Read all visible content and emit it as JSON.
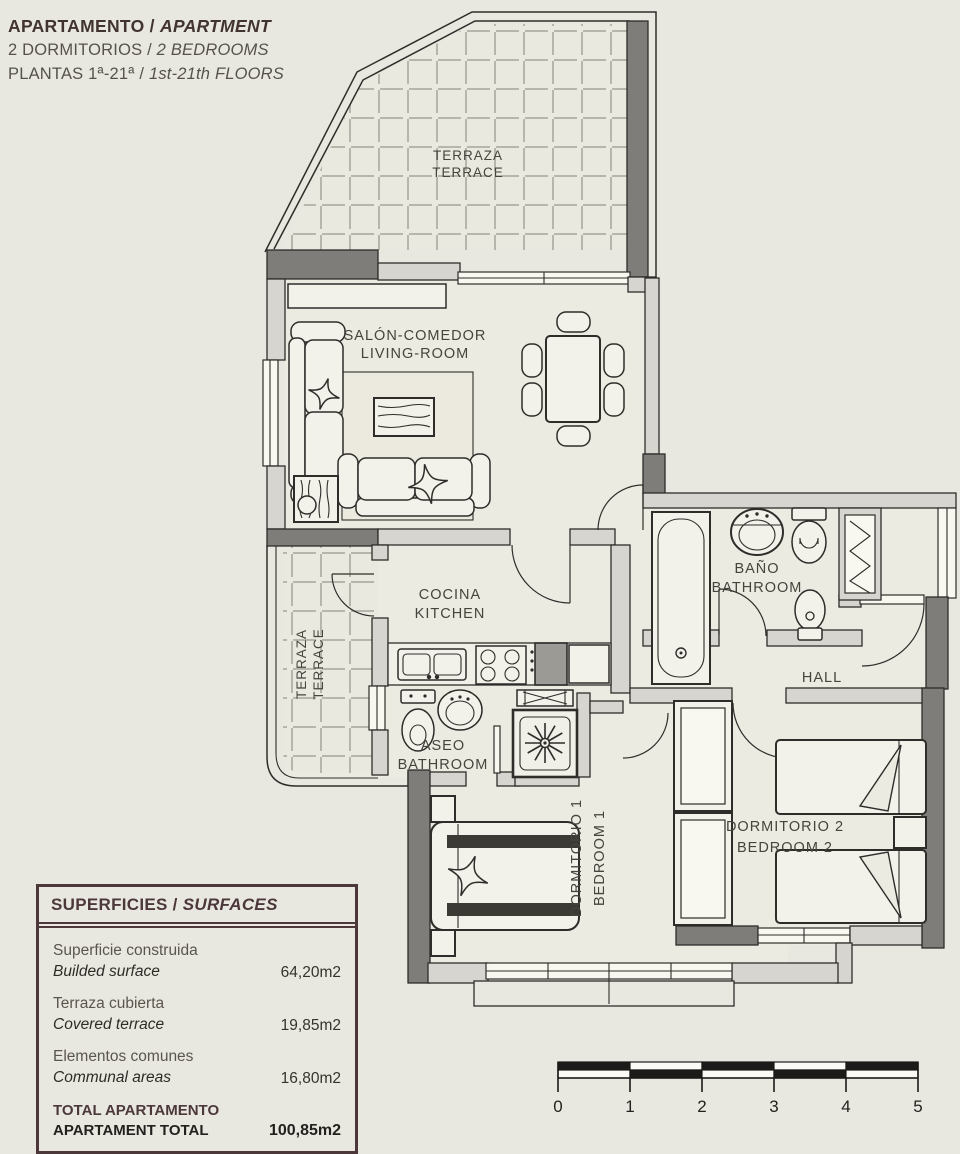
{
  "title": {
    "es": "APARTAMENTO",
    "sep": " / ",
    "en": "APARTMENT"
  },
  "subtitle1": {
    "es": "2 DORMITORIOS",
    "sep": " / ",
    "en": "2 BEDROOMS"
  },
  "subtitle2": {
    "es": "PLANTAS 1ª-21ª",
    "sep": " / ",
    "en": "1st-21th FLOORS"
  },
  "rooms": {
    "terrace_top": {
      "line1": "TERRAZA",
      "line2": "TERRACE"
    },
    "living": {
      "line1": "SALÓN-COMEDOR",
      "line2": "LIVING-ROOM"
    },
    "kitchen": {
      "line1": "COCINA",
      "line2": "KITCHEN"
    },
    "bathroom": {
      "line1": "BAÑO",
      "line2": "BATHROOM"
    },
    "hall": {
      "line1": "HALL"
    },
    "aseo": {
      "line1": "ASEO",
      "line2": "BATHROOM"
    },
    "terrace_side": {
      "line1": "TERRAZA",
      "line2": "TERRACE"
    },
    "bedroom1": {
      "line1": "DORMITORIO 1",
      "line2": "BEDROOM 1"
    },
    "bedroom2": {
      "line1": "DORMITORIO 2",
      "line2": "BEDROOM 2"
    }
  },
  "surfaces": {
    "title_es": "SUPERFICIES",
    "title_sep": " / ",
    "title_en": "SURFACES",
    "rows": [
      {
        "es": "Superficie construida",
        "en": "Builded surface",
        "value": "64,20m2"
      },
      {
        "es": "Terraza cubierta",
        "en": "Covered terrace",
        "value": "19,85m2"
      },
      {
        "es": "Elementos comunes",
        "en": "Communal areas",
        "value": "16,80m2"
      }
    ],
    "total_es": "TOTAL APARTAMENTO",
    "total_en": "APARTAMENT TOTAL",
    "total_value": "100,85m2"
  },
  "scale_bar": {
    "labels": [
      "0",
      "1",
      "2",
      "3",
      "4",
      "5"
    ]
  },
  "colors": {
    "background": "#e9e8e0",
    "wall": "#d6d5cf",
    "dark_wall": "#7e7d79",
    "line": "#2e2d2a",
    "accent": "#4c383b"
  }
}
